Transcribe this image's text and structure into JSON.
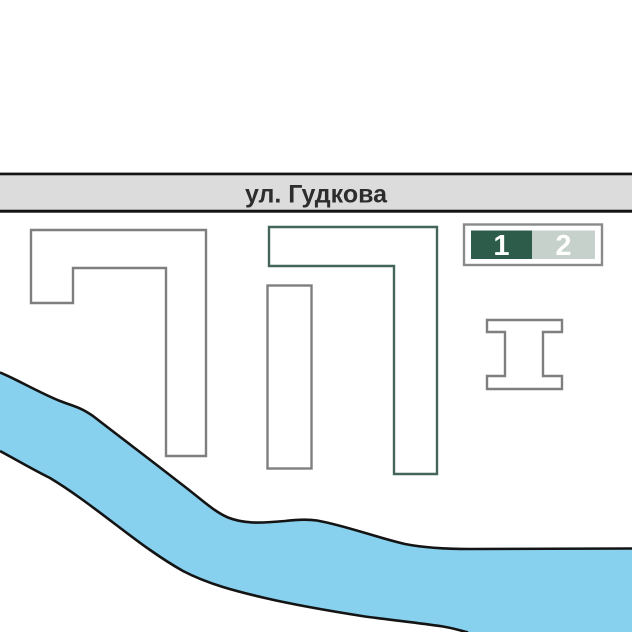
{
  "street": {
    "label": "ул. Гудкова"
  },
  "legend": {
    "items": [
      {
        "label": "1",
        "color": "#2e5c4b",
        "text_color": "#ffffff"
      },
      {
        "label": "2",
        "color": "#c5d1ca",
        "text_color": "#ffffff"
      }
    ]
  },
  "colors": {
    "street_fill": "#dcdcdc",
    "street_line": "#141414",
    "street_text": "#2d2d2d",
    "building_fill": "#ffffff",
    "building_stroke_gray": "#7f7f7f",
    "building_stroke_green": "#44665a",
    "river_fill": "#87d1ee",
    "river_bank_stroke": "#141414",
    "legend_border": "#8a8a8a"
  },
  "map_objects": {
    "buildings_count": 4,
    "river_present": true
  }
}
